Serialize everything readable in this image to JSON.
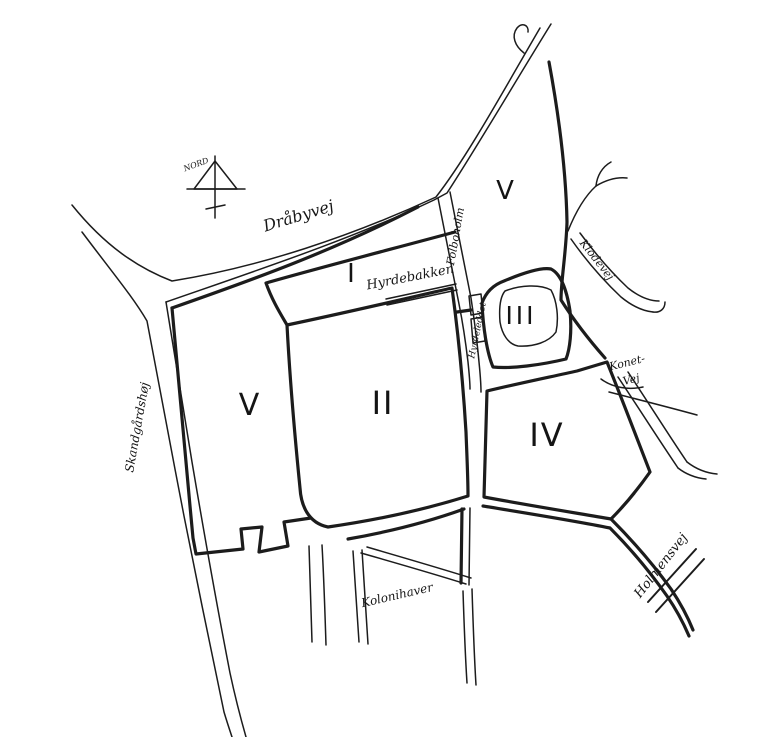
{
  "map": {
    "compass_label": "NORD",
    "zone_numerals": {
      "z1": "I",
      "z2": "II",
      "z3": "III",
      "z4": "IV",
      "z5_west": "V",
      "z5_north": "V"
    },
    "road_labels": {
      "draabyvej": "Dråbyvej",
      "folboholm": "Folboholm",
      "hyrdebakken": "Hyrdebakken",
      "hyrdeleddet": "Hyrdeleddet",
      "klodevej": "Klodevej",
      "konetvej_line1": "Konet-",
      "konetvej_line2": "Vej",
      "holmensvej": "Holmensvej",
      "kolonihaver": "Kolonihaver",
      "skandgaardshoej": "Skandgårdshøj"
    },
    "colors": {
      "ink": "#1c1c1c",
      "paper": "#ffffff"
    }
  }
}
